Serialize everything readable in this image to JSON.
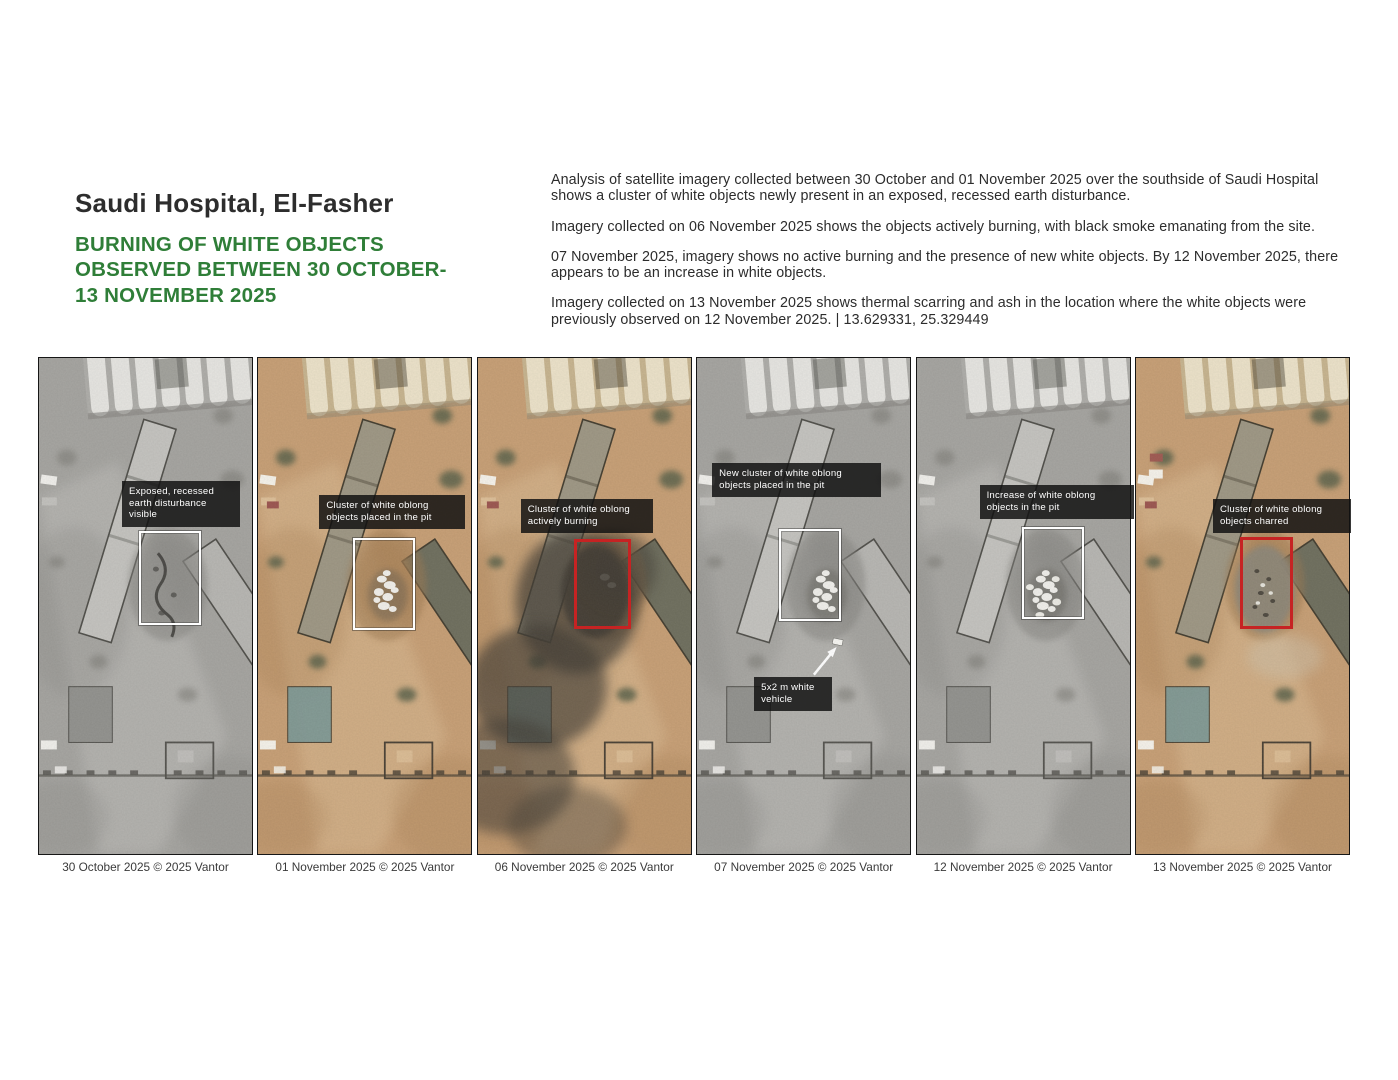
{
  "header": {
    "title": "Saudi Hospital, El-Fasher",
    "subtitle_lines": [
      "BURNING OF WHITE OBJECTS",
      "OBSERVED BETWEEN 30 OCTOBER-",
      "13 NOVEMBER 2025"
    ]
  },
  "analysis": {
    "paragraphs": [
      "Analysis of satellite imagery collected between 30 October and 01 November 2025 over the southside of Saudi Hospital shows a cluster of white objects newly present in an exposed, recessed earth disturbance.",
      "Imagery collected on 06 November 2025 shows the objects actively burning, with black smoke emanating from the site.",
      "07 November 2025, imagery shows no active burning and the presence of new white objects. By 12 November 2025, there appears to be an increase in white objects.",
      "Imagery collected on 13 November 2025 shows thermal scarring and ash in the location where the white objects were previously observed on 12 November 2025. | 13.629331, 25.329449"
    ],
    "coordinates": "13.629331, 25.329449"
  },
  "colors": {
    "accent_green": "#2f7e38",
    "highlight_red": "#c62323",
    "highlight_white": "#ffffff",
    "annotation_bg": "#111111",
    "body_text": "#2c2c2c"
  },
  "panels": [
    {
      "id": "30-oct",
      "caption": "30 October 2025 © 2025 Vantor",
      "variant": "grayscale",
      "pit_content": "disturbance",
      "box": {
        "color": "#ffffff",
        "x": 101,
        "y": 174,
        "w": 62,
        "h": 94
      },
      "annotation": {
        "text": "Exposed, recessed earth disturbance visible",
        "x": 84,
        "y": 124,
        "w": 104
      }
    },
    {
      "id": "01-nov",
      "caption": "01 November 2025 © 2025 Vantor",
      "variant": "color",
      "pit_content": "white-cluster",
      "box": {
        "color": "#ffffff",
        "x": 96,
        "y": 181,
        "w": 62,
        "h": 92
      },
      "annotation": {
        "text": "Cluster of white oblong objects placed in the pit",
        "x": 62,
        "y": 138,
        "w": 132
      }
    },
    {
      "id": "06-nov",
      "caption": "06 November 2025 © 2025 Vantor",
      "variant": "color",
      "smoke": true,
      "pit_content": "burning",
      "box": {
        "color": "#c62323",
        "x": 97,
        "y": 182,
        "w": 57,
        "h": 90
      },
      "annotation": {
        "text": "Cluster of white oblong actively burning",
        "x": 44,
        "y": 142,
        "w": 118
      }
    },
    {
      "id": "07-nov",
      "caption": "07 November 2025 © 2025 Vantor",
      "variant": "grayscale",
      "pit_content": "white-cluster",
      "box": {
        "color": "#ffffff",
        "x": 83,
        "y": 172,
        "w": 62,
        "h": 92
      },
      "annotation": {
        "text": "New cluster of white oblong objects placed in the pit",
        "x": 16,
        "y": 106,
        "w": 155
      },
      "annotation2": {
        "text": "5x2 m white vehicle",
        "x": 58,
        "y": 320,
        "w": 64
      },
      "arrow": {
        "x1": 118,
        "y1": 318,
        "x2": 140,
        "y2": 291
      }
    },
    {
      "id": "12-nov",
      "caption": "12 November 2025 © 2025 Vantor",
      "variant": "grayscale",
      "pit_content": "white-cluster-large",
      "box": {
        "color": "#ffffff",
        "x": 106,
        "y": 170,
        "w": 62,
        "h": 92
      },
      "annotation": {
        "text": "Increase  of white oblong objects in the pit",
        "x": 64,
        "y": 128,
        "w": 140
      }
    },
    {
      "id": "13-nov",
      "caption": "13 November 2025 © 2025 Vantor",
      "variant": "color",
      "red_vehicle": true,
      "pit_content": "charred",
      "box": {
        "color": "#c62323",
        "x": 105,
        "y": 180,
        "w": 53,
        "h": 92
      },
      "annotation": {
        "text": "Cluster of white oblong objects charred",
        "x": 78,
        "y": 142,
        "w": 124
      }
    }
  ]
}
